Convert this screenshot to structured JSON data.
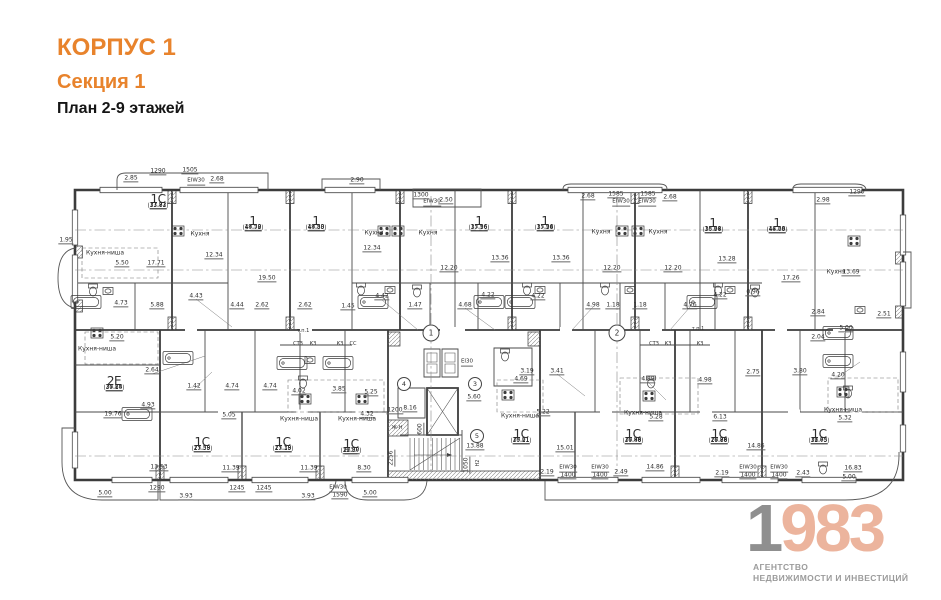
{
  "header": {
    "building": "КОРПУС 1",
    "section": "Секция 1",
    "plan_title": "План 2-9 этажей"
  },
  "logo": {
    "digit_first": "1",
    "digits_rest": "983",
    "tagline1": "АГЕНТСТВО",
    "tagline2": "НЕДВИЖИМОСТИ И ИНВЕСТИЦИЙ"
  },
  "colors": {
    "accent_orange": "#E8832C",
    "logo_gray": "#8F8F8F",
    "logo_peach": "#ECB49D",
    "plan_line": "#3C3C3C"
  },
  "plan": {
    "apartments": [
      {
        "type": "1С",
        "a1": "17.71",
        "a2": "31.82",
        "a3": "(33.83)",
        "x": 158,
        "y": 206
      },
      {
        "type": "1",
        "a1": "19.50",
        "a2": "43.38",
        "a3": "(44.72)",
        "x": 253,
        "y": 228
      },
      {
        "type": "1",
        "a1": "19.50",
        "a2": "43.38",
        "a3": "(44.83)",
        "x": 316,
        "y": 228
      },
      {
        "type": "1",
        "a1": "13.36",
        "a2": "35.96",
        "a3": "(37.16)",
        "x": 479,
        "y": 228
      },
      {
        "type": "1",
        "a1": "15.36",
        "a2": "35.94",
        "a3": "(37.28)",
        "x": 545,
        "y": 228
      },
      {
        "type": "1",
        "a1": "13.28",
        "a2": "35.64",
        "a3": "(36.98)",
        "x": 713,
        "y": 230
      },
      {
        "type": "1",
        "a1": "17.26",
        "a2": "44.59",
        "a3": "(46.08)",
        "x": 777,
        "y": 230
      },
      {
        "type": "2Е",
        "a1": "24.28",
        "a2": "37.85",
        "a3": "(39.14)",
        "x": 114,
        "y": 388
      },
      {
        "type": "1С",
        "a1": "11.39",
        "a2": "25.58",
        "a3": "(27.55)",
        "x": 202,
        "y": 449
      },
      {
        "type": "1С",
        "a1": "11.39",
        "a2": "25.18",
        "a3": "(27.15)",
        "x": 283,
        "y": 449
      },
      {
        "type": "1С",
        "a1": "8.30",
        "a2": "19.80",
        "a3": "(21.37)",
        "x": 351,
        "y": 451
      },
      {
        "type": "1С",
        "a1": "15.01",
        "a2": "29.11",
        "a3": "(30.21)",
        "x": 521,
        "y": 441
      },
      {
        "type": "1С",
        "a1": "14.86",
        "a2": "29.98",
        "a3": "(30.48)",
        "x": 633,
        "y": 441
      },
      {
        "type": "1С",
        "a1": "14.86",
        "a2": "28.78",
        "a3": "(29.88)",
        "x": 719,
        "y": 441
      },
      {
        "type": "1С",
        "a1": "16.83",
        "a2": "31.65",
        "a3": "(32.75)",
        "x": 819,
        "y": 441
      }
    ],
    "rooms": [
      {
        "t": "Кухня-ниша",
        "x": 105,
        "y": 253
      },
      {
        "t": "Кухня",
        "x": 200,
        "y": 234
      },
      {
        "t": "Кухня",
        "x": 374,
        "y": 233
      },
      {
        "t": "Кухня",
        "x": 428,
        "y": 233
      },
      {
        "t": "Кухня",
        "x": 601,
        "y": 232
      },
      {
        "t": "Кухня",
        "x": 658,
        "y": 232
      },
      {
        "t": "Кухня",
        "x": 836,
        "y": 272
      },
      {
        "t": "Кухня-ниша",
        "x": 97,
        "y": 349
      },
      {
        "t": "Кухня-ниша",
        "x": 299,
        "y": 419
      },
      {
        "t": "Кухня-ниша",
        "x": 357,
        "y": 419
      },
      {
        "t": "Кухня-ниша",
        "x": 520,
        "y": 416
      },
      {
        "t": "Кухня-ниша",
        "x": 643,
        "y": 413
      },
      {
        "t": "Кухня-ниша",
        "x": 843,
        "y": 410
      }
    ],
    "dims": [
      {
        "t": "2.85",
        "x": 131,
        "y": 179
      },
      {
        "t": "1290",
        "x": 158,
        "y": 172
      },
      {
        "t": "1505",
        "x": 190,
        "y": 171
      },
      {
        "t": "2.68",
        "x": 217,
        "y": 180
      },
      {
        "t": "2.90",
        "x": 357,
        "y": 181
      },
      {
        "t": "1300",
        "x": 421,
        "y": 196
      },
      {
        "t": "2.50",
        "x": 446,
        "y": 201
      },
      {
        "t": "2.68",
        "x": 588,
        "y": 197
      },
      {
        "t": "1585",
        "x": 616,
        "y": 195
      },
      {
        "t": "1585",
        "x": 648,
        "y": 195
      },
      {
        "t": "2.68",
        "x": 670,
        "y": 198
      },
      {
        "t": "2.98",
        "x": 823,
        "y": 201
      },
      {
        "t": "1290",
        "x": 857,
        "y": 193
      },
      {
        "t": "1.95",
        "x": 66,
        "y": 241
      },
      {
        "t": "5.50",
        "x": 122,
        "y": 264
      },
      {
        "t": "17.71",
        "x": 156,
        "y": 264
      },
      {
        "t": "12.34",
        "x": 214,
        "y": 256
      },
      {
        "t": "12.34",
        "x": 372,
        "y": 249
      },
      {
        "t": "13.36",
        "x": 500,
        "y": 259
      },
      {
        "t": "13.36",
        "x": 561,
        "y": 259
      },
      {
        "t": "13.28",
        "x": 727,
        "y": 260
      },
      {
        "t": "17.26",
        "x": 791,
        "y": 279
      },
      {
        "t": "13.69",
        "x": 851,
        "y": 273
      },
      {
        "t": "12.20",
        "x": 449,
        "y": 269
      },
      {
        "t": "12.20",
        "x": 612,
        "y": 269
      },
      {
        "t": "12.20",
        "x": 673,
        "y": 269
      },
      {
        "t": "19.50",
        "x": 267,
        "y": 279
      },
      {
        "t": "4.73",
        "x": 121,
        "y": 304
      },
      {
        "t": "5.88",
        "x": 157,
        "y": 306
      },
      {
        "t": "4.43",
        "x": 196,
        "y": 297
      },
      {
        "t": "4.44",
        "x": 237,
        "y": 306
      },
      {
        "t": "2.62",
        "x": 262,
        "y": 306
      },
      {
        "t": "2.62",
        "x": 305,
        "y": 306
      },
      {
        "t": "1.45",
        "x": 348,
        "y": 307
      },
      {
        "t": "4.42",
        "x": 382,
        "y": 297
      },
      {
        "t": "1.47",
        "x": 415,
        "y": 306
      },
      {
        "t": "4.68",
        "x": 465,
        "y": 306
      },
      {
        "t": "4.22",
        "x": 488,
        "y": 296
      },
      {
        "t": "4.22",
        "x": 538,
        "y": 297
      },
      {
        "t": "4.98",
        "x": 593,
        "y": 306
      },
      {
        "t": "1.18",
        "x": 613,
        "y": 306
      },
      {
        "t": "1.18",
        "x": 640,
        "y": 306
      },
      {
        "t": "4.26",
        "x": 690,
        "y": 306
      },
      {
        "t": "4.22",
        "x": 720,
        "y": 296
      },
      {
        "t": "0.96",
        "x": 753,
        "y": 293
      },
      {
        "t": "2.84",
        "x": 818,
        "y": 313
      },
      {
        "t": "2.04",
        "x": 818,
        "y": 338
      },
      {
        "t": "2.51",
        "x": 884,
        "y": 315
      },
      {
        "t": "5.00",
        "x": 846,
        "y": 329
      },
      {
        "t": "5.20",
        "x": 117,
        "y": 338
      },
      {
        "t": "2.64",
        "x": 152,
        "y": 371
      },
      {
        "t": "1.42",
        "x": 194,
        "y": 387
      },
      {
        "t": "4.74",
        "x": 232,
        "y": 387
      },
      {
        "t": "4.74",
        "x": 270,
        "y": 387
      },
      {
        "t": "4.93",
        "x": 148,
        "y": 406
      },
      {
        "t": "19.76",
        "x": 113,
        "y": 415
      },
      {
        "t": "5.05",
        "x": 229,
        "y": 416
      },
      {
        "t": "4.02",
        "x": 299,
        "y": 392
      },
      {
        "t": "3.85",
        "x": 339,
        "y": 390
      },
      {
        "t": "5.25",
        "x": 371,
        "y": 393
      },
      {
        "t": "4.32",
        "x": 367,
        "y": 415
      },
      {
        "t": "1200",
        "x": 395,
        "y": 411
      },
      {
        "t": "8.16",
        "x": 410,
        "y": 409
      },
      {
        "t": "600",
        "x": 421,
        "y": 429,
        "v": 1
      },
      {
        "t": "2256",
        "x": 392,
        "y": 458,
        "v": 1
      },
      {
        "t": "1050",
        "x": 467,
        "y": 465,
        "v": 1
      },
      {
        "t": "5.60",
        "x": 474,
        "y": 398
      },
      {
        "t": "13.88",
        "x": 475,
        "y": 447
      },
      {
        "t": "3.19",
        "x": 527,
        "y": 372
      },
      {
        "t": "3.41",
        "x": 557,
        "y": 372
      },
      {
        "t": "4.69",
        "x": 521,
        "y": 380
      },
      {
        "t": "4.89",
        "x": 648,
        "y": 380
      },
      {
        "t": "4.98",
        "x": 705,
        "y": 381
      },
      {
        "t": "5.22",
        "x": 543,
        "y": 413
      },
      {
        "t": "5.28",
        "x": 656,
        "y": 418
      },
      {
        "t": "6.13",
        "x": 720,
        "y": 418
      },
      {
        "t": "2.75",
        "x": 753,
        "y": 373
      },
      {
        "t": "3.80",
        "x": 800,
        "y": 372
      },
      {
        "t": "4.20",
        "x": 838,
        "y": 376
      },
      {
        "t": "5.32",
        "x": 845,
        "y": 419
      },
      {
        "t": "5.00",
        "x": 849,
        "y": 478
      },
      {
        "t": "13.53",
        "x": 159,
        "y": 468
      },
      {
        "t": "11.39",
        "x": 231,
        "y": 469
      },
      {
        "t": "11.39",
        "x": 309,
        "y": 469
      },
      {
        "t": "8.30",
        "x": 364,
        "y": 469
      },
      {
        "t": "15.01",
        "x": 565,
        "y": 449
      },
      {
        "t": "14.86",
        "x": 655,
        "y": 468
      },
      {
        "t": "14.86",
        "x": 756,
        "y": 447
      },
      {
        "t": "16.83",
        "x": 853,
        "y": 469
      },
      {
        "t": "5.00",
        "x": 105,
        "y": 494
      },
      {
        "t": "1290",
        "x": 157,
        "y": 489
      },
      {
        "t": "3.93",
        "x": 186,
        "y": 497
      },
      {
        "t": "1245",
        "x": 237,
        "y": 489
      },
      {
        "t": "1245",
        "x": 264,
        "y": 489
      },
      {
        "t": "3.93",
        "x": 308,
        "y": 497
      },
      {
        "t": "1590",
        "x": 340,
        "y": 496
      },
      {
        "t": "5.00",
        "x": 370,
        "y": 494
      },
      {
        "t": "2.19",
        "x": 547,
        "y": 473
      },
      {
        "t": "1400",
        "x": 568,
        "y": 476
      },
      {
        "t": "1400",
        "x": 600,
        "y": 476
      },
      {
        "t": "2.49",
        "x": 621,
        "y": 473
      },
      {
        "t": "2.19",
        "x": 722,
        "y": 474
      },
      {
        "t": "1400",
        "x": 748,
        "y": 476
      },
      {
        "t": "1400",
        "x": 779,
        "y": 476
      },
      {
        "t": "2.43",
        "x": 803,
        "y": 474
      }
    ],
    "fire": [
      {
        "t": "EIW30",
        "x": 196,
        "y": 182
      },
      {
        "t": "EIW30",
        "x": 432,
        "y": 203
      },
      {
        "t": "EIW30",
        "x": 621,
        "y": 203
      },
      {
        "t": "EIW30",
        "x": 647,
        "y": 203
      },
      {
        "t": "EI30",
        "x": 467,
        "y": 363
      },
      {
        "t": "EIW30",
        "x": 568,
        "y": 469
      },
      {
        "t": "EIW30",
        "x": 600,
        "y": 469
      },
      {
        "t": "EIW30",
        "x": 748,
        "y": 469
      },
      {
        "t": "EIW30",
        "x": 779,
        "y": 469
      },
      {
        "t": "EIW30",
        "x": 338,
        "y": 489
      }
    ],
    "small": [
      {
        "t": "СТЗ",
        "x": 298,
        "y": 344
      },
      {
        "t": "КЗ",
        "x": 313,
        "y": 344
      },
      {
        "t": "КЗ",
        "x": 340,
        "y": 344
      },
      {
        "t": "СС",
        "x": 353,
        "y": 344
      },
      {
        "t": "СТЗ",
        "x": 654,
        "y": 344
      },
      {
        "t": "КЗ",
        "x": 668,
        "y": 344
      },
      {
        "t": "КЗ",
        "x": 700,
        "y": 344
      },
      {
        "t": "т.п.1",
        "x": 303,
        "y": 331
      },
      {
        "t": "т.п.1",
        "x": 698,
        "y": 329
      },
      {
        "t": "Ж-Н",
        "x": 397,
        "y": 428
      },
      {
        "t": "Н2",
        "x": 478,
        "y": 463,
        "v": 1
      }
    ],
    "axis_bubbles": [
      {
        "n": "1",
        "x": 431,
        "y": 333
      },
      {
        "n": "2",
        "x": 617,
        "y": 333
      }
    ],
    "area_bubbles": [
      {
        "n": "3",
        "x": 475,
        "y": 384
      },
      {
        "n": "4",
        "x": 404,
        "y": 384
      },
      {
        "n": "5",
        "x": 477,
        "y": 436
      }
    ],
    "fixtures": {
      "stoves": [
        [
          178,
          231
        ],
        [
          384,
          231
        ],
        [
          398,
          231
        ],
        [
          622,
          231
        ],
        [
          638,
          231
        ],
        [
          854,
          241
        ],
        [
          97,
          333
        ],
        [
          508,
          395
        ],
        [
          649,
          396
        ],
        [
          843,
          392
        ],
        [
          305,
          399
        ],
        [
          362,
          399
        ]
      ],
      "tubs": [
        [
          86,
          302
        ],
        [
          373,
          302
        ],
        [
          489,
          302
        ],
        [
          520,
          302
        ],
        [
          702,
          302
        ],
        [
          838,
          333
        ],
        [
          838,
          361
        ],
        [
          292,
          363
        ],
        [
          338,
          363
        ],
        [
          178,
          358
        ],
        [
          137,
          414
        ]
      ],
      "toilets": [
        [
          93,
          290
        ],
        [
          361,
          289
        ],
        [
          417,
          291
        ],
        [
          527,
          289
        ],
        [
          605,
          289
        ],
        [
          718,
          289
        ],
        [
          755,
          291
        ],
        [
          303,
          382
        ],
        [
          651,
          382
        ],
        [
          505,
          355
        ],
        [
          848,
          392
        ],
        [
          823,
          468
        ]
      ],
      "sinks": [
        [
          108,
          291
        ],
        [
          390,
          290
        ],
        [
          540,
          290
        ],
        [
          630,
          290
        ],
        [
          730,
          290
        ],
        [
          310,
          360
        ],
        [
          860,
          310
        ]
      ]
    }
  }
}
